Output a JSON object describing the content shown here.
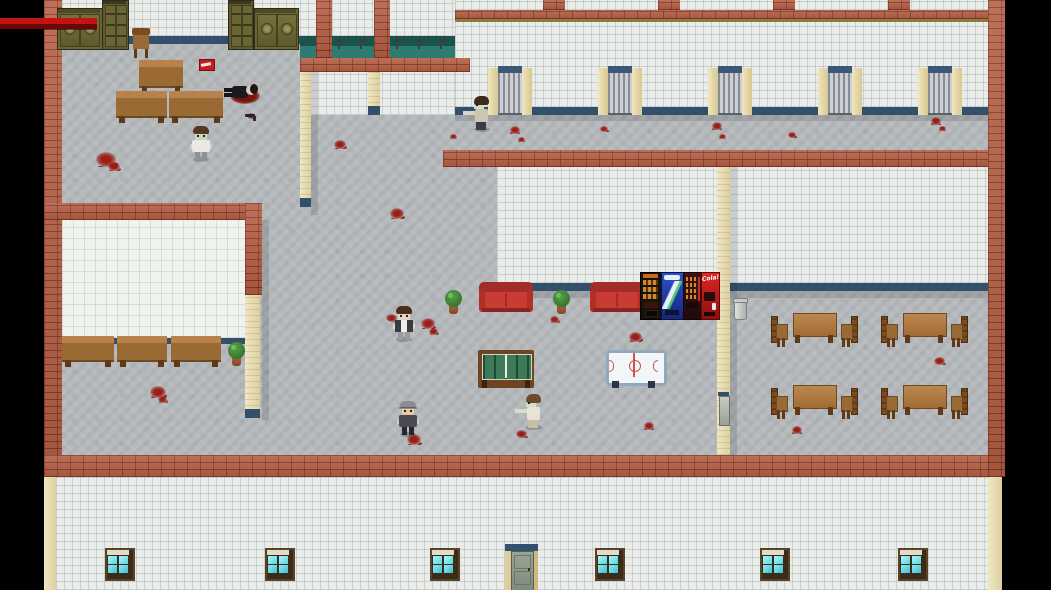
{
  "meta": {
    "scene": "top-down-survival-hospital-map",
    "viewport_w": 1051,
    "viewport_h": 590
  },
  "labels": {
    "cola": "Cola!"
  },
  "hud": {
    "health_bar": {
      "x": 0,
      "y": 18,
      "w": 97,
      "h": 12,
      "color_top": "#c21414",
      "color_bottom": "#700505"
    }
  },
  "palette": {
    "background": "#000000",
    "brick_wall": "#b65f45",
    "floor_gray": "#b5b9bb",
    "wall_tile_white": "#e9ece9",
    "baseboard_blue": "#32506c",
    "pillar_cream": "#e9ddae",
    "sink_teal": "#2e7c70",
    "blood_red": "#9a160e",
    "wood_brown": "#9a6a34",
    "couch_red": "#c83c34",
    "window_cyan": "#56d8e2",
    "hud_health_red": "#c21414"
  },
  "entities": [
    {
      "t": "blood",
      "n": "blood-splat",
      "x": 96,
      "y": 152,
      "s": 20
    },
    {
      "t": "blood",
      "n": "blood-splat",
      "x": 108,
      "y": 162,
      "s": 12
    },
    {
      "t": "blood",
      "n": "blood-splat",
      "x": 247,
      "y": 113,
      "s": 8
    },
    {
      "t": "blood",
      "n": "blood-splat",
      "x": 334,
      "y": 140,
      "s": 12
    },
    {
      "t": "blood",
      "n": "blood-splat",
      "x": 390,
      "y": 208,
      "s": 14
    },
    {
      "t": "blood",
      "n": "blood-splat",
      "x": 150,
      "y": 386,
      "s": 16
    },
    {
      "t": "blood",
      "n": "blood-splat",
      "x": 158,
      "y": 396,
      "s": 9
    },
    {
      "t": "blood",
      "n": "blood-splat",
      "x": 386,
      "y": 314,
      "s": 11
    },
    {
      "t": "blood",
      "n": "blood-splat",
      "x": 421,
      "y": 318,
      "s": 14
    },
    {
      "t": "blood",
      "n": "blood-splat",
      "x": 429,
      "y": 328,
      "s": 9
    },
    {
      "t": "blood",
      "n": "blood-splat",
      "x": 550,
      "y": 316,
      "s": 9
    },
    {
      "t": "blood",
      "n": "blood-splat",
      "x": 629,
      "y": 332,
      "s": 13
    },
    {
      "t": "blood",
      "n": "blood-splat",
      "x": 644,
      "y": 422,
      "s": 10
    },
    {
      "t": "blood",
      "n": "blood-splat",
      "x": 407,
      "y": 434,
      "s": 14
    },
    {
      "t": "blood",
      "n": "blood-splat",
      "x": 516,
      "y": 430,
      "s": 11
    },
    {
      "t": "blood",
      "n": "blood-splat",
      "x": 510,
      "y": 126,
      "s": 10
    },
    {
      "t": "blood",
      "n": "blood-splat",
      "x": 518,
      "y": 137,
      "s": 7
    },
    {
      "t": "blood",
      "n": "blood-splat",
      "x": 600,
      "y": 126,
      "s": 8
    },
    {
      "t": "blood",
      "n": "blood-splat",
      "x": 712,
      "y": 122,
      "s": 10
    },
    {
      "t": "blood",
      "n": "blood-splat",
      "x": 719,
      "y": 134,
      "s": 7
    },
    {
      "t": "blood",
      "n": "blood-splat",
      "x": 788,
      "y": 132,
      "s": 8
    },
    {
      "t": "blood",
      "n": "blood-splat",
      "x": 931,
      "y": 117,
      "s": 10
    },
    {
      "t": "blood",
      "n": "blood-splat",
      "x": 939,
      "y": 126,
      "s": 7
    },
    {
      "t": "blood",
      "n": "blood-splat",
      "x": 450,
      "y": 134,
      "s": 7
    },
    {
      "t": "blood",
      "n": "blood-splat",
      "x": 792,
      "y": 426,
      "s": 10
    },
    {
      "t": "blood",
      "n": "blood-splat",
      "x": 934,
      "y": 357,
      "s": 11
    },
    {
      "t": "cabw",
      "n": "cabinet-double-left",
      "x": 57,
      "y": 8,
      "w": 44,
      "h": 40
    },
    {
      "t": "cabt",
      "n": "bookshelf-left",
      "x": 102,
      "y": 0,
      "w": 25,
      "h": 48
    },
    {
      "t": "chairw",
      "n": "office-chair",
      "x": 130,
      "y": 28,
      "w": 22,
      "h": 34
    },
    {
      "t": "cabt",
      "n": "bookshelf-right",
      "x": 228,
      "y": 0,
      "w": 24,
      "h": 48
    },
    {
      "t": "cabw",
      "n": "cabinet-double-right",
      "x": 254,
      "y": 8,
      "w": 43,
      "h": 40
    },
    {
      "t": "desk",
      "n": "office-desk",
      "x": 139,
      "y": 60,
      "w": 44,
      "h": 34
    },
    {
      "t": "bench",
      "n": "office-bench-left",
      "x": 116,
      "y": 91,
      "w": 51,
      "h": 32
    },
    {
      "t": "bench",
      "n": "office-bench-right",
      "x": 169,
      "y": 91,
      "w": 54,
      "h": 32
    },
    {
      "t": "bench",
      "n": "waiting-bench-1",
      "x": 62,
      "y": 336,
      "w": 52,
      "h": 31
    },
    {
      "t": "bench",
      "n": "waiting-bench-2",
      "x": 117,
      "y": 336,
      "w": 50,
      "h": 31
    },
    {
      "t": "bench",
      "n": "waiting-bench-3",
      "x": 171,
      "y": 336,
      "w": 50,
      "h": 31
    },
    {
      "t": "plant",
      "n": "potted-plant",
      "x": 228,
      "y": 342,
      "w": 17,
      "h": 24
    },
    {
      "t": "plant",
      "n": "potted-plant",
      "x": 445,
      "y": 290,
      "w": 17,
      "h": 24
    },
    {
      "t": "plant",
      "n": "potted-plant",
      "x": 553,
      "y": 290,
      "w": 17,
      "h": 24
    },
    {
      "t": "couch",
      "n": "red-couch-left",
      "x": 479,
      "y": 282,
      "w": 54,
      "h": 33
    },
    {
      "t": "couch",
      "n": "red-couch-right",
      "x": 590,
      "y": 282,
      "w": 54,
      "h": 33
    },
    {
      "t": "vendcoffee",
      "n": "vending-machine-coffee",
      "x": 640,
      "y": 272,
      "w": 21,
      "h": 46
    },
    {
      "t": "vendsoda",
      "n": "vending-machine-soda",
      "x": 661,
      "y": 272,
      "w": 22,
      "h": 46
    },
    {
      "t": "vendsnack",
      "n": "vending-machine-snack",
      "x": 683,
      "y": 272,
      "w": 18,
      "h": 46
    },
    {
      "t": "vendcola",
      "n": "vending-machine-cola",
      "x": 701,
      "y": 272,
      "w": 17,
      "h": 46,
      "label": "Cola!"
    },
    {
      "t": "trash",
      "n": "trash-can",
      "x": 733,
      "y": 296,
      "w": 13,
      "h": 23
    },
    {
      "t": "foos",
      "n": "foosball-table",
      "x": 478,
      "y": 350,
      "w": 56,
      "h": 38
    },
    {
      "t": "airhockey",
      "n": "air-hockey-table",
      "x": 606,
      "y": 350,
      "w": 55,
      "h": 38
    },
    {
      "t": "table",
      "n": "dining-table",
      "x": 793,
      "y": 313,
      "w": 42,
      "h": 30
    },
    {
      "t": "table",
      "n": "dining-table",
      "x": 903,
      "y": 313,
      "w": 42,
      "h": 30
    },
    {
      "t": "table",
      "n": "dining-table",
      "x": 793,
      "y": 385,
      "w": 42,
      "h": 30
    },
    {
      "t": "table",
      "n": "dining-table",
      "x": 903,
      "y": 385,
      "w": 42,
      "h": 30
    },
    {
      "t": "dchair",
      "n": "dining-chair",
      "x": 771,
      "y": 316,
      "w": 16,
      "h": 31,
      "back": "l"
    },
    {
      "t": "dchair",
      "n": "dining-chair",
      "x": 840,
      "y": 316,
      "w": 16,
      "h": 31,
      "back": "r"
    },
    {
      "t": "dchair",
      "n": "dining-chair",
      "x": 881,
      "y": 316,
      "w": 16,
      "h": 31,
      "back": "l"
    },
    {
      "t": "dchair",
      "n": "dining-chair",
      "x": 950,
      "y": 316,
      "w": 16,
      "h": 31,
      "back": "r"
    },
    {
      "t": "dchair",
      "n": "dining-chair",
      "x": 771,
      "y": 388,
      "w": 16,
      "h": 31,
      "back": "l"
    },
    {
      "t": "dchair",
      "n": "dining-chair",
      "x": 840,
      "y": 388,
      "w": 16,
      "h": 31,
      "back": "r"
    },
    {
      "t": "dchair",
      "n": "dining-chair",
      "x": 881,
      "y": 388,
      "w": 16,
      "h": 31,
      "back": "l"
    },
    {
      "t": "dchair",
      "n": "dining-chair",
      "x": 950,
      "y": 388,
      "w": 16,
      "h": 31,
      "back": "r"
    },
    {
      "t": "redbook",
      "n": "dropped-red-item",
      "x": 199,
      "y": 59,
      "w": 14,
      "h": 10
    },
    {
      "t": "pistol",
      "n": "dropped-pistol",
      "x": 245,
      "y": 112,
      "w": 14,
      "h": 9
    },
    {
      "t": "ddoor",
      "n": "divider-doorway",
      "x": 718,
      "y": 392,
      "w": 11,
      "h": 32
    },
    {
      "t": "gate",
      "n": "barred-gate",
      "x": 488,
      "y": 66,
      "w": 44,
      "h": 49
    },
    {
      "t": "gate",
      "n": "barred-gate",
      "x": 598,
      "y": 66,
      "w": 44,
      "h": 49
    },
    {
      "t": "gate",
      "n": "barred-gate",
      "x": 708,
      "y": 66,
      "w": 44,
      "h": 49
    },
    {
      "t": "gate",
      "n": "barred-gate",
      "x": 818,
      "y": 66,
      "w": 44,
      "h": 49
    },
    {
      "t": "gate",
      "n": "barred-gate",
      "x": 918,
      "y": 66,
      "w": 44,
      "h": 49
    },
    {
      "t": "faucet",
      "n": "sink-faucet",
      "x": 338,
      "y": 38,
      "w": 7,
      "h": 11
    },
    {
      "t": "faucet",
      "n": "sink-faucet",
      "x": 360,
      "y": 38,
      "w": 7,
      "h": 11
    },
    {
      "t": "faucet",
      "n": "sink-faucet",
      "x": 396,
      "y": 38,
      "w": 7,
      "h": 11
    },
    {
      "t": "faucet",
      "n": "sink-faucet",
      "x": 418,
      "y": 38,
      "w": 7,
      "h": 11
    },
    {
      "t": "faucet",
      "n": "sink-faucet",
      "x": 440,
      "y": 38,
      "w": 7,
      "h": 11
    },
    {
      "t": "window",
      "n": "exterior-window",
      "x": 105,
      "y": 548,
      "w": 26,
      "h": 29
    },
    {
      "t": "window",
      "n": "exterior-window",
      "x": 265,
      "y": 548,
      "w": 26,
      "h": 29
    },
    {
      "t": "window",
      "n": "exterior-window",
      "x": 430,
      "y": 548,
      "w": 26,
      "h": 29
    },
    {
      "t": "window",
      "n": "exterior-window",
      "x": 595,
      "y": 548,
      "w": 26,
      "h": 29
    },
    {
      "t": "window",
      "n": "exterior-window",
      "x": 760,
      "y": 548,
      "w": 26,
      "h": 29
    },
    {
      "t": "window",
      "n": "exterior-window",
      "x": 898,
      "y": 548,
      "w": 26,
      "h": 29
    },
    {
      "t": "door",
      "n": "exterior-door",
      "x": 505,
      "y": 544,
      "w": 33,
      "h": 46
    },
    {
      "t": "char",
      "n": "zombie-hall",
      "x": 191,
      "y": 126,
      "w": 20,
      "h": 36,
      "dir": "down",
      "hair": "#553722",
      "skin": "#ccd4bc",
      "top": "#e9e9e2",
      "pants": "#8d9298"
    },
    {
      "t": "corpse",
      "n": "dead-body",
      "x": 224,
      "y": 78,
      "w": 38,
      "h": 28
    },
    {
      "t": "char",
      "n": "zombie-corridor",
      "x": 472,
      "y": 96,
      "w": 20,
      "h": 36,
      "dir": "left",
      "hair": "#3a2a1a",
      "skin": "#d6d6c8",
      "top": "#cdc6b2",
      "pants": "#3b3b44"
    },
    {
      "t": "char",
      "n": "zombie-lounge",
      "x": 394,
      "y": 306,
      "w": 20,
      "h": 36,
      "dir": "down",
      "hair": "#4a2f16",
      "skin": "#e0d6c6",
      "top": "#efeee6",
      "pants": "#989da3",
      "vest": "#3a3a42"
    },
    {
      "t": "char",
      "n": "survivor-capped",
      "x": 398,
      "y": 401,
      "w": 20,
      "h": 36,
      "dir": "down",
      "hair": "#878d93",
      "skin": "#e6c6a6",
      "top": "#4a4a52",
      "pants": "#25252b",
      "cap": true
    },
    {
      "t": "char",
      "n": "zombie-cafeteria",
      "x": 524,
      "y": 394,
      "w": 20,
      "h": 36,
      "dir": "left",
      "hair": "#6b4b2b",
      "skin": "#d6deca",
      "top": "#e7e3d6",
      "pants": "#c6bea6"
    },
    {
      "t": "hpbar",
      "n": "health-bar",
      "x": 0,
      "y": 18,
      "w": 97,
      "h": 12,
      "topc": "#c21414",
      "botc": "#700505"
    }
  ]
}
